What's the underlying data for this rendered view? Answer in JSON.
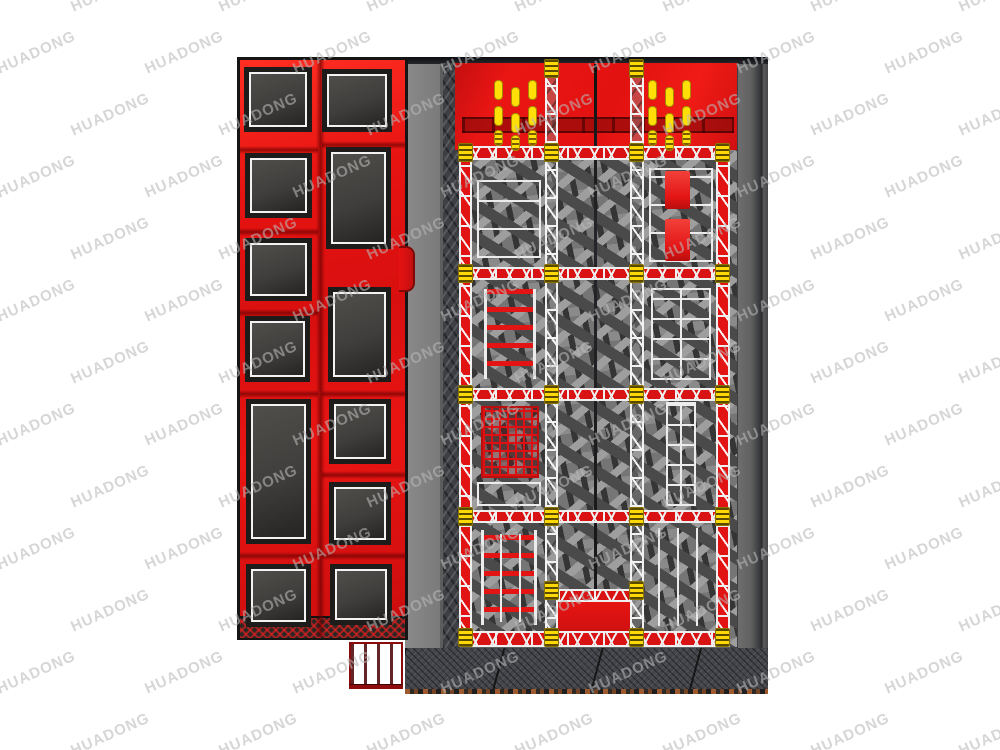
{
  "watermark": {
    "text": "HUADONG"
  },
  "colors": {
    "red": "#e11313",
    "red_dark": "#b80e0e",
    "yellow": "#ffd906",
    "white_line": "#efefef",
    "walkway_gray": "#7d7d7d",
    "platform_gray": "#5e5e5e",
    "trampoline_mat": "#413f3d",
    "frame_black": "#17171a",
    "watermark_gray": "#b9b9b9"
  },
  "scene": {
    "description": "Top view render of an indoor trampoline park: left red trampoline grid zone, right foam-pit platform with truss-framed lanes, ladders, cargo net and ninja rig",
    "left_zone": {
      "structure": {
        "x": 237,
        "y": 57,
        "w": 171,
        "h": 583
      },
      "trampolines": [
        {
          "x": 249,
          "y": 72,
          "w": 58,
          "h": 55
        },
        {
          "x": 250,
          "y": 158,
          "w": 57,
          "h": 55
        },
        {
          "x": 250,
          "y": 243,
          "w": 57,
          "h": 53
        },
        {
          "x": 250,
          "y": 321,
          "w": 55,
          "h": 56
        },
        {
          "x": 251,
          "y": 404,
          "w": 55,
          "h": 135
        },
        {
          "x": 251,
          "y": 569,
          "w": 55,
          "h": 53
        },
        {
          "x": 327,
          "y": 74,
          "w": 60,
          "h": 53
        },
        {
          "x": 331,
          "y": 152,
          "w": 55,
          "h": 92
        },
        {
          "x": 333,
          "y": 292,
          "w": 53,
          "h": 85
        },
        {
          "x": 334,
          "y": 404,
          "w": 52,
          "h": 55
        },
        {
          "x": 334,
          "y": 487,
          "w": 52,
          "h": 53
        },
        {
          "x": 335,
          "y": 569,
          "w": 52,
          "h": 51
        }
      ],
      "seams_h": [
        {
          "x": 240,
          "y": 146,
          "w": 78,
          "h": 8
        },
        {
          "x": 240,
          "y": 228,
          "w": 78,
          "h": 8
        },
        {
          "x": 240,
          "y": 309,
          "w": 78,
          "h": 8
        },
        {
          "x": 240,
          "y": 390,
          "w": 78,
          "h": 8
        },
        {
          "x": 240,
          "y": 552,
          "w": 78,
          "h": 8
        },
        {
          "x": 322,
          "y": 141,
          "w": 84,
          "h": 8
        },
        {
          "x": 322,
          "y": 390,
          "w": 84,
          "h": 8
        },
        {
          "x": 322,
          "y": 471,
          "w": 84,
          "h": 8
        },
        {
          "x": 322,
          "y": 552,
          "w": 84,
          "h": 8
        }
      ],
      "seam_v": {
        "x": 316,
        "y": 60,
        "w": 9,
        "h": 577
      },
      "bump": {
        "x": 399,
        "y": 246,
        "w": 16,
        "h": 46
      },
      "skirt": {
        "x": 240,
        "y": 616,
        "w": 165,
        "h": 22
      },
      "stairs": {
        "x": 349,
        "y": 642,
        "w": 54,
        "h": 46
      }
    },
    "foam_zone": {
      "platform": {
        "x": 405,
        "y": 57,
        "w": 363,
        "h": 637
      },
      "walkway": {
        "x": 405,
        "y": 57,
        "w": 55,
        "h": 633
      },
      "climb_strip": {
        "x": 443,
        "y": 63,
        "w": 17,
        "h": 585
      },
      "red_band": {
        "x": 455,
        "y": 63,
        "w": 282,
        "h": 87
      },
      "band_shadow": {
        "x": 462,
        "y": 117,
        "w": 272,
        "h": 16
      },
      "foam": {
        "x": 460,
        "y": 150,
        "w": 277,
        "h": 497
      },
      "divider": {
        "x": 594,
        "y": 64,
        "w": 3,
        "h": 581
      },
      "columns": [
        {
          "x": 459,
          "y": 146,
          "w": 13,
          "h": 501,
          "kind": "t-red"
        },
        {
          "x": 545,
          "y": 62,
          "w": 13,
          "h": 585,
          "kind": "t-white"
        },
        {
          "x": 630,
          "y": 62,
          "w": 14,
          "h": 585,
          "kind": "t-white"
        },
        {
          "x": 716,
          "y": 146,
          "w": 14,
          "h": 501,
          "kind": "t-red"
        }
      ],
      "beams": [
        {
          "x": 459,
          "y": 146,
          "w": 271,
          "h": 14
        },
        {
          "x": 459,
          "y": 267,
          "w": 271,
          "h": 13
        },
        {
          "x": 459,
          "y": 388,
          "w": 271,
          "h": 13
        },
        {
          "x": 459,
          "y": 510,
          "w": 271,
          "h": 13
        },
        {
          "x": 459,
          "y": 631,
          "w": 271,
          "h": 16
        },
        {
          "x": 558,
          "y": 589,
          "w": 73,
          "h": 13
        }
      ],
      "pad_cols_x": [
        458,
        544,
        629,
        715
      ],
      "pad_rows_y": [
        143,
        264,
        385,
        507,
        628
      ],
      "extra_pads": [
        [
          544,
          59
        ],
        [
          629,
          59
        ],
        [
          544,
          581
        ],
        [
          629,
          581
        ]
      ],
      "yellow_clusters": [
        {
          "x": 494,
          "y": 80
        },
        {
          "x": 648,
          "y": 80
        }
      ],
      "cluster_bars": [
        [
          0,
          0,
          0
        ],
        [
          17,
          7,
          0
        ],
        [
          34,
          0,
          0
        ],
        [
          0,
          26,
          0
        ],
        [
          17,
          33,
          0
        ],
        [
          34,
          26,
          0
        ],
        [
          0,
          50,
          1
        ],
        [
          17,
          55,
          1
        ],
        [
          34,
          50,
          1
        ]
      ],
      "elements": [
        {
          "type": "white-box",
          "x": 477,
          "y": 180,
          "w": 64,
          "h": 78
        },
        {
          "type": "ladder-red",
          "x": 484,
          "y": 289,
          "w": 52,
          "h": 90
        },
        {
          "type": "net",
          "x": 481,
          "y": 406,
          "w": 58,
          "h": 72
        },
        {
          "type": "white-box",
          "x": 477,
          "y": 482,
          "w": 64,
          "h": 24
        },
        {
          "type": "ladder-red",
          "x": 481,
          "y": 530,
          "w": 56,
          "h": 95
        },
        {
          "type": "white-box",
          "x": 649,
          "y": 168,
          "w": 64,
          "h": 94
        },
        {
          "type": "red-mat",
          "x": 665,
          "y": 171,
          "w": 25,
          "h": 38
        },
        {
          "type": "red-mat",
          "x": 665,
          "y": 219,
          "w": 25,
          "h": 42
        },
        {
          "type": "ladder-white",
          "x": 651,
          "y": 288,
          "w": 60,
          "h": 92
        },
        {
          "type": "ladder-white",
          "x": 666,
          "y": 402,
          "w": 30,
          "h": 104
        },
        {
          "type": "rails",
          "x": 658,
          "y": 528,
          "w": 46,
          "h": 98
        },
        {
          "type": "rails",
          "x": 500,
          "y": 534,
          "w": 38,
          "h": 88
        }
      ],
      "red_platform": {
        "x": 558,
        "y": 600,
        "w": 73,
        "h": 45
      }
    }
  }
}
